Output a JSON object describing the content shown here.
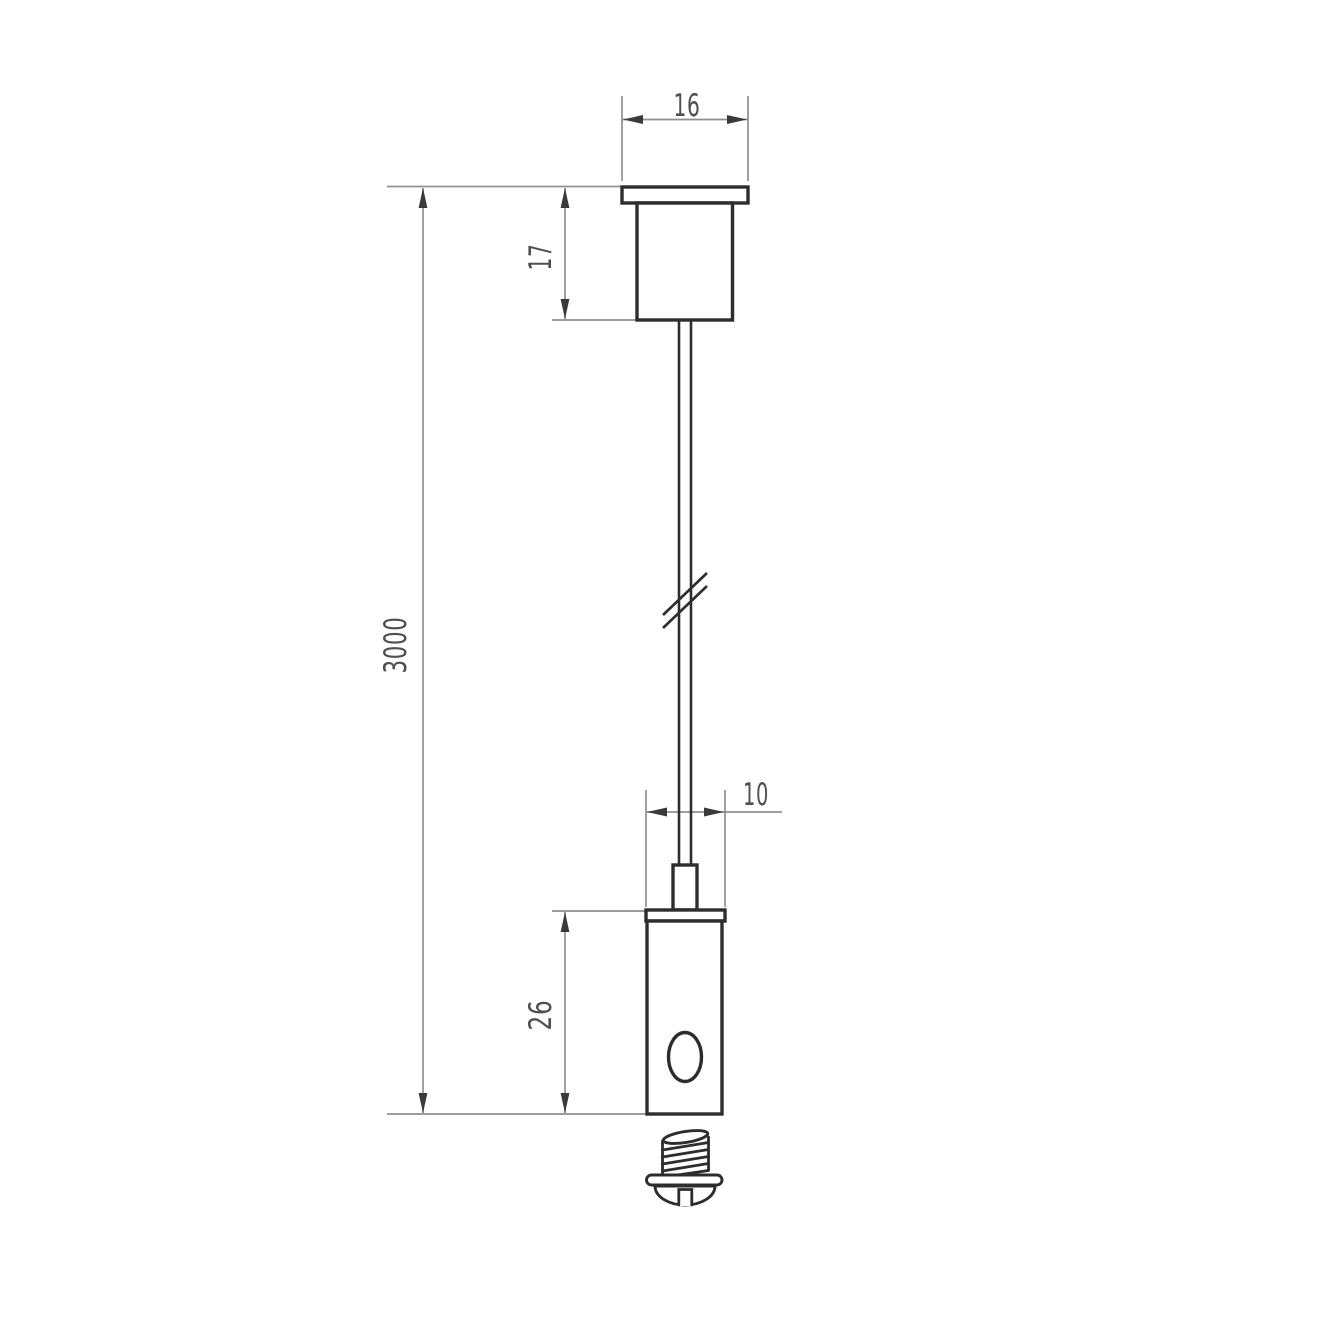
{
  "drawing": {
    "dimensions": {
      "canopy_width": "16",
      "canopy_height": "17",
      "wire_length": "3000",
      "gripper_width": "10",
      "gripper_height": "26"
    },
    "colors": {
      "background": "#ffffff",
      "part_outline": "#2d2d2d",
      "dimension_line": "#8f8f8f",
      "arrowhead": "#3a3a3a",
      "dimension_text": "#4f4f4f"
    }
  }
}
